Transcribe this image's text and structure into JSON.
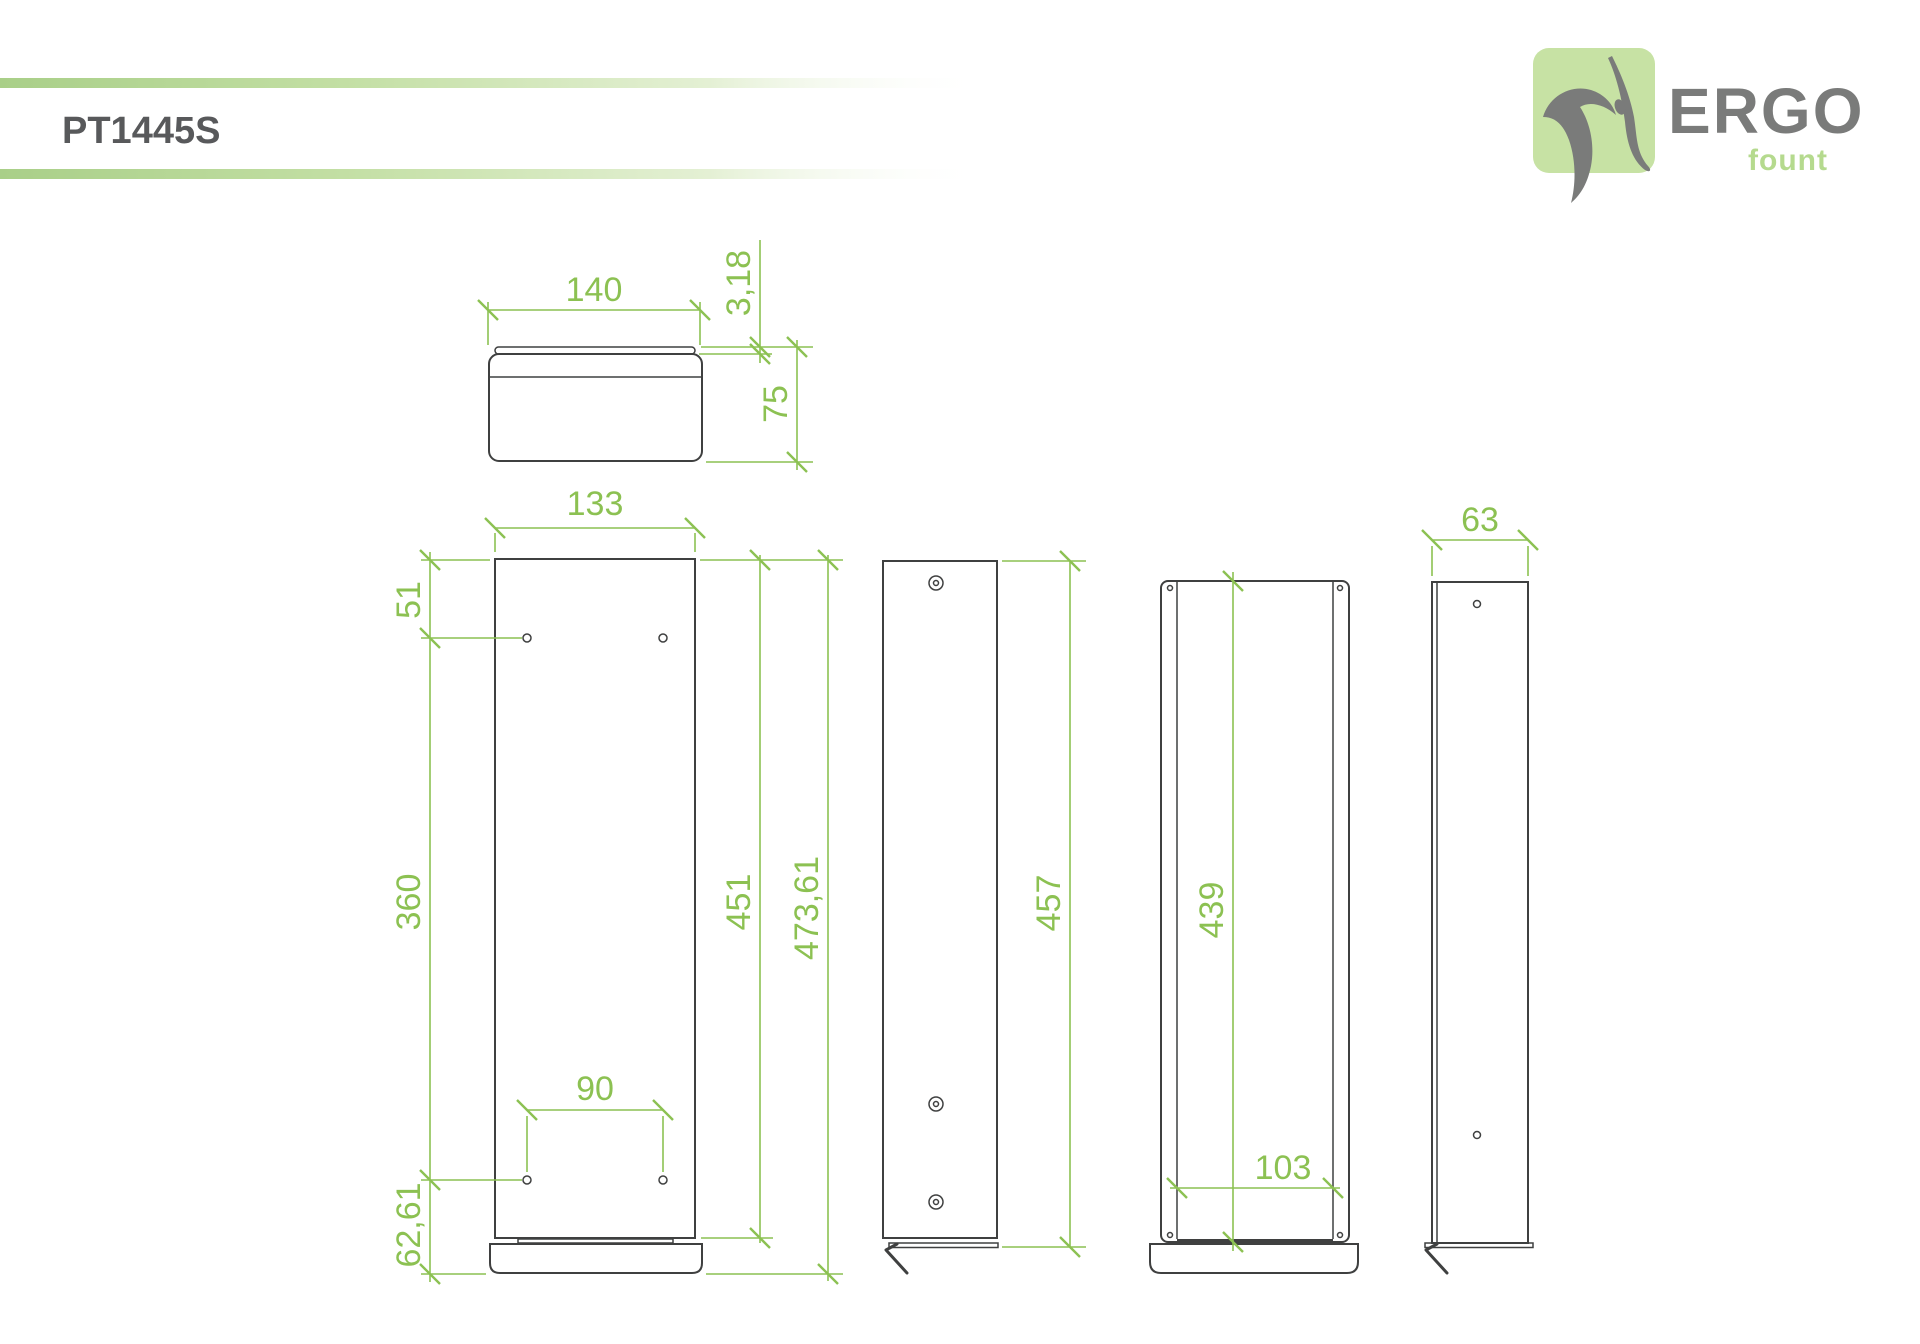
{
  "header": {
    "title": "PT1445S"
  },
  "logo": {
    "brand": "ERGO",
    "sub": "fount"
  },
  "colors": {
    "dimension_green": "#8cc152",
    "accent_bar_green": "#b7d999",
    "outline_dark": "#3f4040",
    "title_gray": "#58595b",
    "logo_square_green": "#c7e2a4",
    "logo_text_gray": "#7a7b7a",
    "logo_sub_green": "#b5da8e"
  },
  "views": {
    "top": {
      "base_width": "140",
      "wall_thickness": "3,18",
      "base_depth": "75"
    },
    "front": {
      "column_width": "133",
      "top_hole_offset": "51",
      "hole_vertical_spacing": "360",
      "hole_horizontal_spacing": "90",
      "bottom_hole_offset": "62,61",
      "column_height": "451",
      "total_height": "473,61"
    },
    "side": {
      "overall_height": "457"
    },
    "back": {
      "inner_height": "439",
      "inner_width": "103"
    },
    "profile": {
      "depth": "63"
    }
  }
}
